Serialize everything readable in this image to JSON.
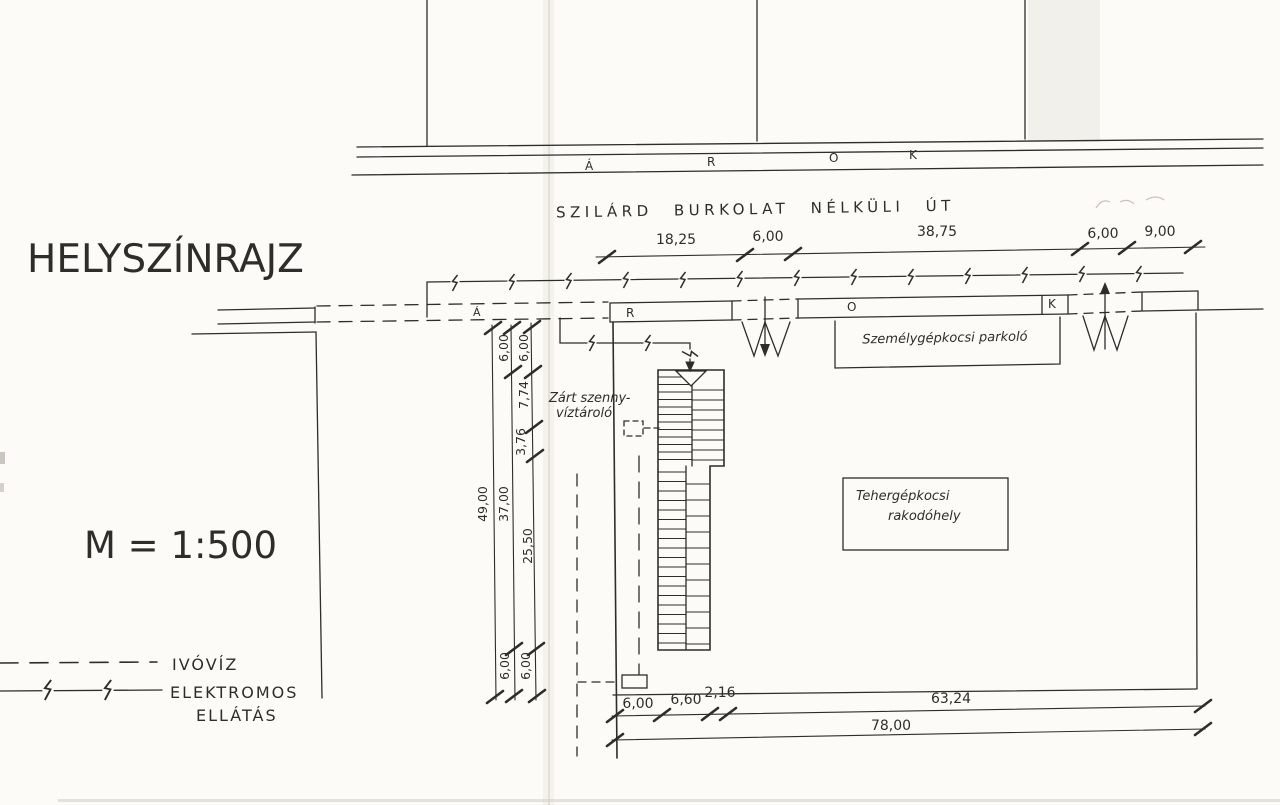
{
  "title": "HELYSZÍNRAJZ",
  "scale": "M = 1:500",
  "legend": {
    "water": "IVÓVÍZ",
    "electric_line1": "ELEKTROMOS",
    "electric_line2": "ELLÁTÁS"
  },
  "road": {
    "label": "SZILÁRD BURKOLAT NÉLKÜLI ÚT",
    "ditch_letters": [
      "Á",
      "R",
      "O",
      "K"
    ]
  },
  "canal": {
    "letters": [
      "Á",
      "R",
      "O",
      "K"
    ]
  },
  "dimensions": {
    "top": [
      "18,25",
      "6,00",
      "38,75",
      "6,00",
      "9,00"
    ],
    "left_outer": "49,00",
    "left_mid": [
      "6,00",
      "37,00",
      "6,00"
    ],
    "left_inner": [
      "6,00",
      "7,74",
      "3,76",
      "25,50",
      "6,00"
    ],
    "bottom": [
      "6,00",
      "6,60",
      "2,16",
      "63,24"
    ],
    "bottom_total": "78,00"
  },
  "labels": {
    "parking": "Személygépkocsi parkoló",
    "loading_line1": "Tehergépkocsi",
    "loading_line2": "rakodóhely",
    "tank_line1": "Zárt szenny-",
    "tank_line2": "víztároló"
  },
  "colors": {
    "ink": "#2f2d2a",
    "paper": "#fcfbf8"
  }
}
